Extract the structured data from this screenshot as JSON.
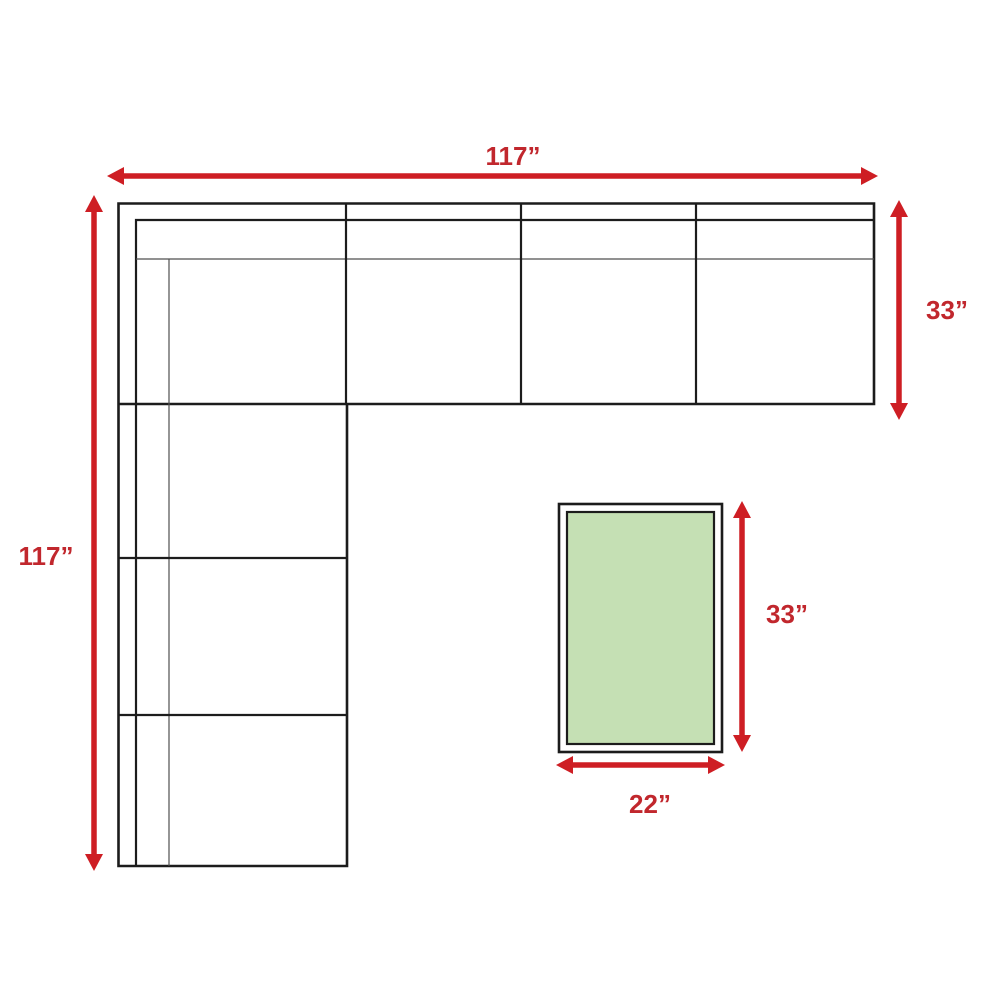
{
  "diagram": {
    "sofa": {
      "width_label": "117”",
      "height_label": "117”",
      "depth_label": "33”"
    },
    "table": {
      "height_label": "33”",
      "width_label": "22”",
      "fill_color": "#c5e0b4"
    },
    "colors": {
      "arrow_red": "#ce1e24",
      "label_red": "#c1272d",
      "line_dark": "#1c1c1c",
      "line_thin": "#4f4f4f",
      "background": "#ffffff"
    }
  }
}
